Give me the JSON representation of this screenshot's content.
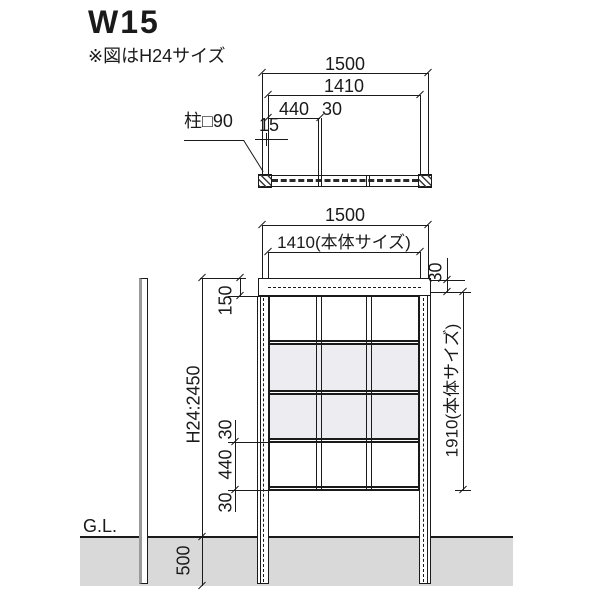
{
  "title": "W15",
  "note": "※図はH24サイズ",
  "colors": {
    "line": "#1a1a1a",
    "ground_fill": "#d9d9d9",
    "panel_fill": "#ededf1",
    "post_edge": "#9a9a9a"
  },
  "plan_view": {
    "dim_1500": "1500",
    "dim_1410": "1410",
    "dim_440": "440",
    "dim_30": "30",
    "dim_15": "15",
    "post_label": "柱□90"
  },
  "elevation_view": {
    "dim_1500": "1500",
    "dim_1410_body": "1410(本体サイズ)",
    "dim_150": "150",
    "dim_30_top": "30",
    "dim_1910_body": "1910(本体サイズ)",
    "dim_total_height": "H24:2450",
    "dim_30_upper": "30",
    "dim_440": "440",
    "dim_30_lower": "30",
    "ground_label": "G.L.",
    "dim_500": "500"
  }
}
